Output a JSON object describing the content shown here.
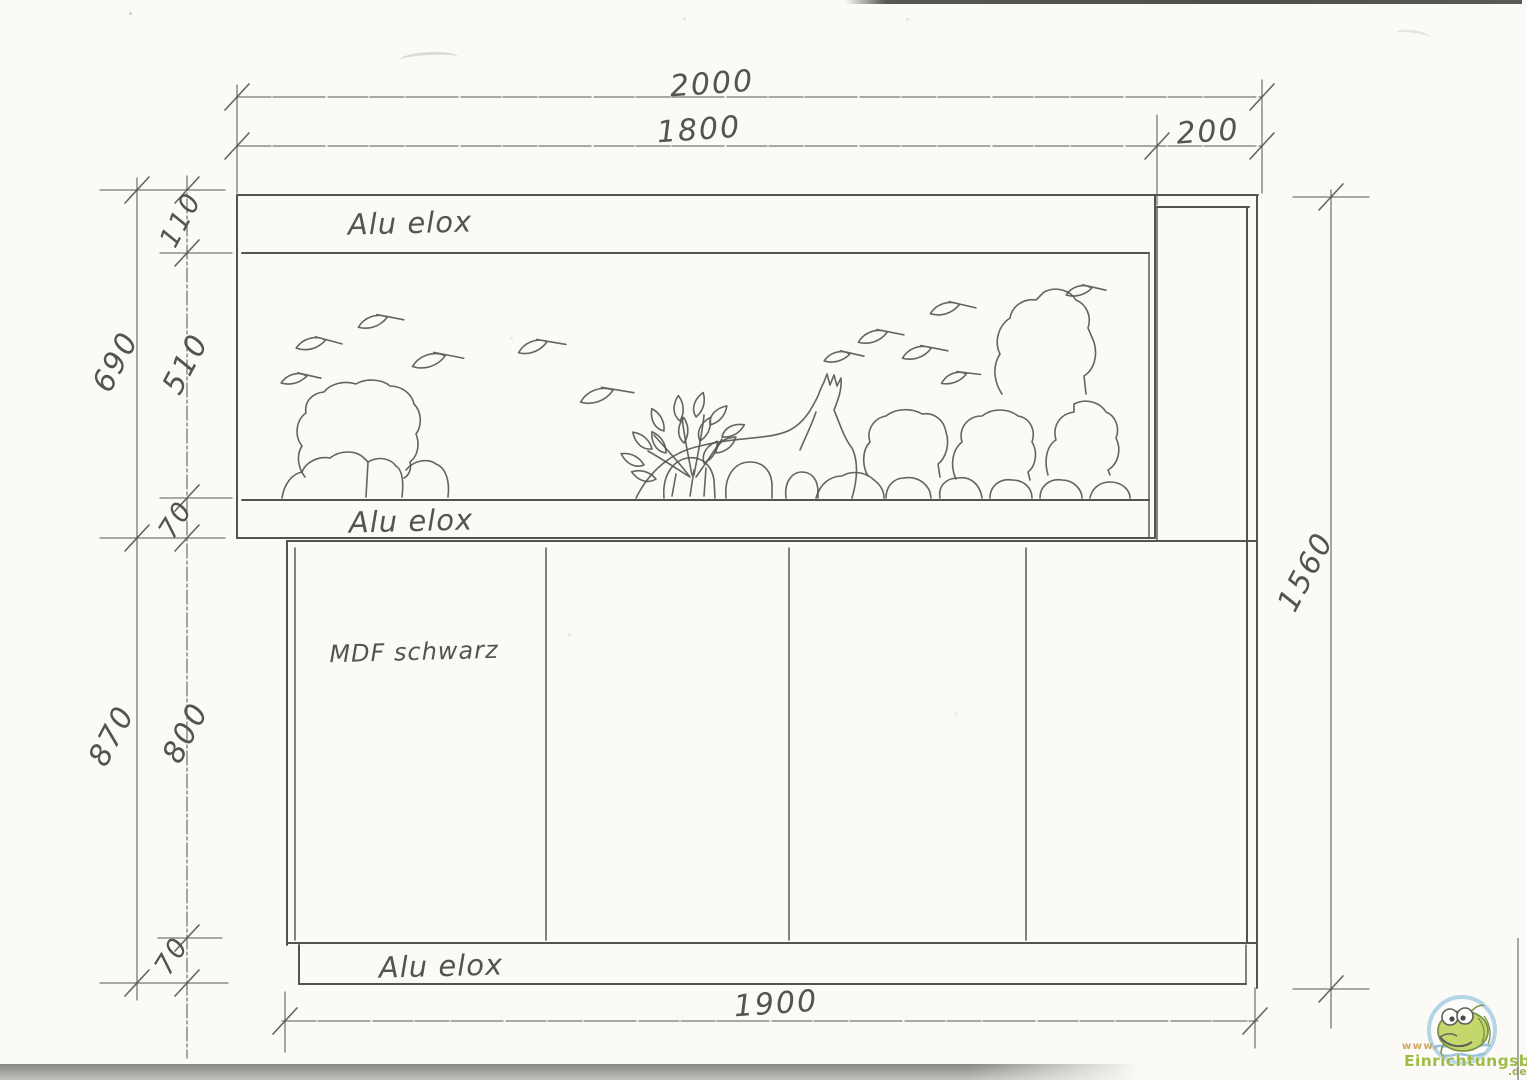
{
  "colors": {
    "pencil": "#55534e",
    "pencil-light": "#6f6d67",
    "paper": "#fbfaf7",
    "wm-green": "#9ab83d",
    "wm-orange": "#cf9a50",
    "wm-blue": "#a5cde2",
    "wm-fish": "#b9d04c"
  },
  "annotations": {
    "alu_top": "Alu elox",
    "alu_mid": "Alu elox",
    "mdf": "MDF schwarz",
    "alu_bottom": "Alu elox"
  },
  "dimensions": {
    "total_width": "2000",
    "tank_width": "1800",
    "side_panel_width": "200",
    "upper_total_height": "690",
    "top_frame": "110",
    "glass_height": "510",
    "lower_frame": "70",
    "lower_total_height": "870",
    "cabinet_height": "800",
    "plinth_height": "70",
    "total_height": "1560",
    "cabinet_width": "1900"
  },
  "watermark": {
    "www": "www.",
    "name": "Einrichtungsbeispiele",
    "tld": ".de"
  }
}
